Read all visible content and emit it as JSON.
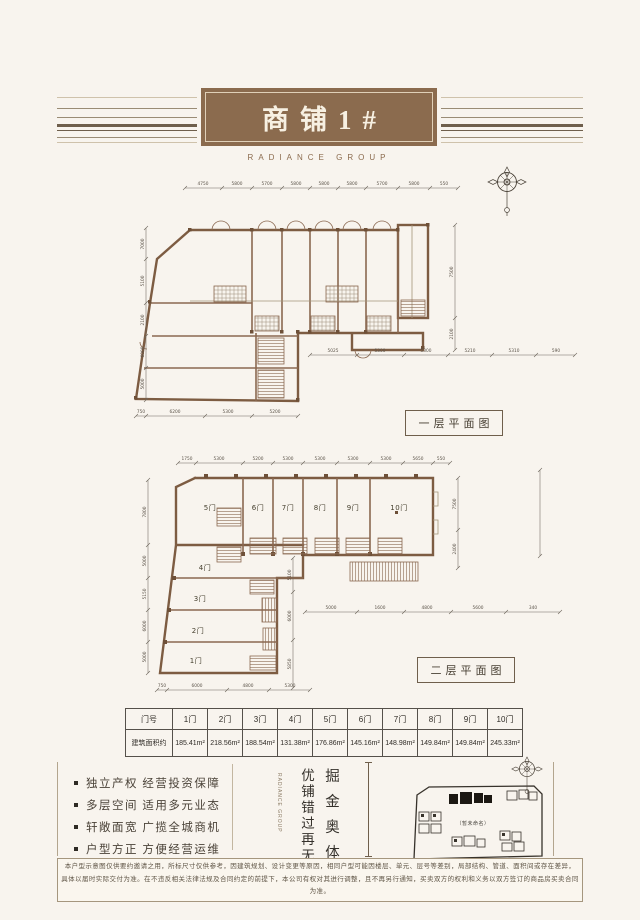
{
  "header": {
    "title": "商铺1#",
    "brand": "RADIANCE GROUP"
  },
  "plan1": {
    "label": "一层平面图",
    "dims_top": [
      "4750",
      "5800",
      "5700",
      "5800",
      "5800",
      "5800",
      "5700",
      "5800",
      "550"
    ],
    "dims_left": [
      "7000",
      "5100",
      "2100",
      "6000",
      "5000"
    ],
    "dims_right": [
      "7500",
      "2100"
    ],
    "dims_mid": [
      "5025",
      "5300",
      "5300",
      "5210",
      "5310",
      "590"
    ],
    "dims_bottom": [
      "750",
      "6200",
      "5300",
      "5200"
    ]
  },
  "plan2": {
    "label": "二层平面图",
    "units_top": [
      "5门",
      "6门",
      "7门",
      "8门",
      "9门",
      "10门"
    ],
    "units_wing": [
      "4门",
      "3门",
      "2门",
      "1门"
    ],
    "dims_top": [
      "1750",
      "5300",
      "5200",
      "5300",
      "5300",
      "5300",
      "5300",
      "5650",
      "550"
    ],
    "dims_left": [
      "7800",
      "5000",
      "5150",
      "6000",
      "5000"
    ],
    "dims_right": [
      "7500",
      "2400"
    ],
    "dims_inner": [
      "5100",
      "6000",
      "5850"
    ],
    "dims_bottom": [
      "750",
      "6000",
      "4800",
      "5300"
    ],
    "dims_bottom_right": [
      "5000",
      "1600",
      "4800",
      "5600",
      "340"
    ]
  },
  "table": {
    "header": [
      "门号",
      "1门",
      "2门",
      "3门",
      "4门",
      "5门",
      "6门",
      "7门",
      "8门",
      "9门",
      "10门"
    ],
    "row_label": "建筑面积约",
    "areas": [
      "185.41m²",
      "218.56m²",
      "188.54m²",
      "131.38m²",
      "176.86m²",
      "145.16m²",
      "148.98m²",
      "149.84m²",
      "149.84m²",
      "245.33m²"
    ]
  },
  "selling_points": [
    "独立产权 经营投资保障",
    "多层空间 适用多元业态",
    "轩敞面宽 广揽全城商机",
    "户型方正 方便经营运维"
  ],
  "slogan": {
    "right": "掘金奥体",
    "left": "优铺错过再无",
    "brand_vertical": "RADIANCE GROUP"
  },
  "map": {
    "note": "（暂未命名）"
  },
  "disclaimer": {
    "l1": "本户型示意图仅供要约邀请之用，所标尺寸仅供参考，因建筑规划、设计变更等原因，相同户型可能因楼层、单元、层号等差别，局部结构、管道、面积间或存在差异，",
    "l2": "具体以届时实际交付为准。在不违反相关法律法规及合同约定的前提下，本公司有权对其进行调整，且不再另行通知，买卖双方的权利和义务以双方签订的商品房买卖合同为准。"
  },
  "colors": {
    "brand_brown": "#8b6b4e",
    "wall_brown": "#7d5c42",
    "background": "#f8f4ee",
    "ink": "#3f3a33"
  }
}
